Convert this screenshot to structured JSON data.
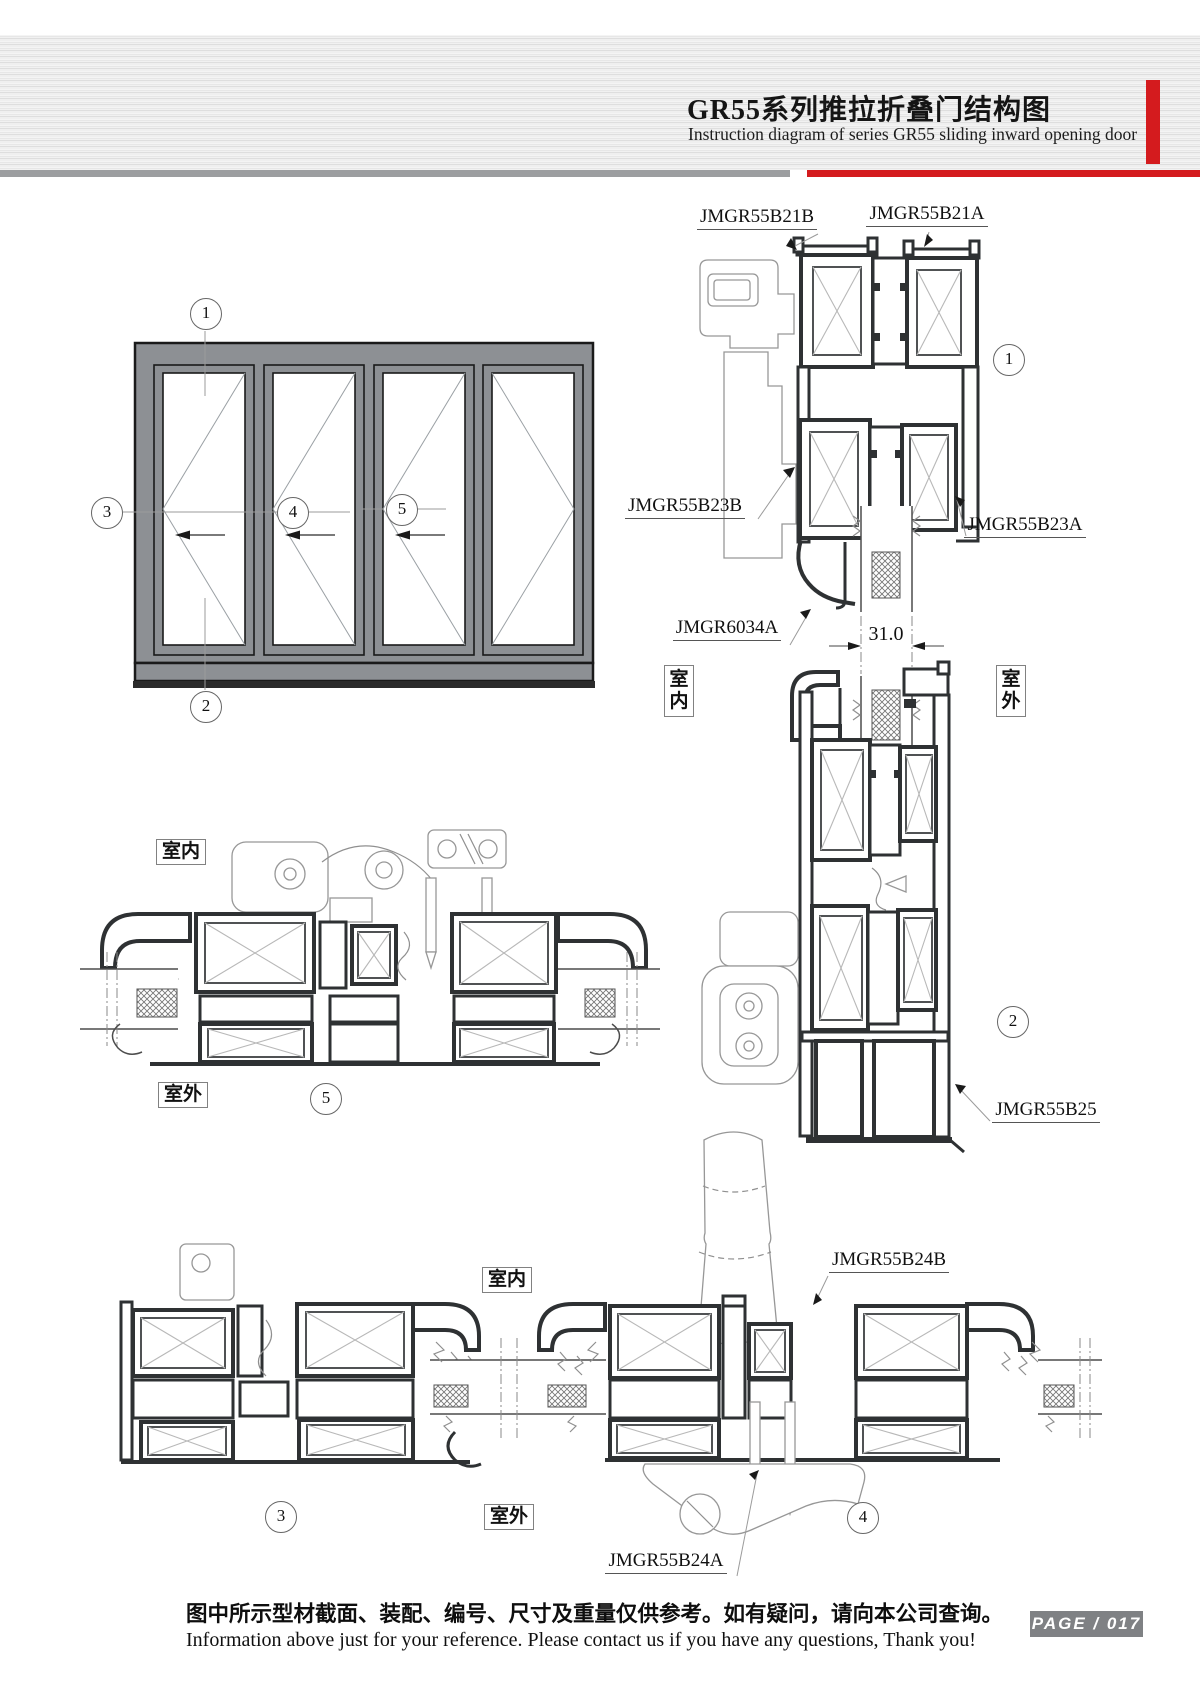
{
  "header": {
    "title_cn": "GR55系列推拉折叠门结构图",
    "title_en": "Instruction diagram of series GR55 sliding inward opening door"
  },
  "diagram": {
    "dimension": "31.0",
    "indoor": "室内",
    "outdoor": "室外",
    "profiles": {
      "b21b": "JMGR55B21B",
      "b21a": "JMGR55B21A",
      "b23b": "JMGR55B23B",
      "b23a": "JMGR55B23A",
      "g6034a": "JMGR6034A",
      "b25": "JMGR55B25",
      "b24b": "JMGR55B24B",
      "b24a": "JMGR55B24A"
    },
    "callouts": {
      "c1": "1",
      "c2": "2",
      "c3": "3",
      "c4": "4",
      "c5": "5"
    }
  },
  "footer": {
    "note_cn": "图中所示型材截面、装配、编号、尺寸及重量仅供参考。如有疑问，请向本公司查询。",
    "note_en": "Information above just for your reference. Please contact us if you have any questions, Thank you!",
    "page": "PAGE / 017"
  },
  "colors": {
    "accent_red": "#d41b1e",
    "rule_gray": "#9c9ea0",
    "frame_gray": "#8d9094",
    "line_dark": "#2e3133"
  }
}
